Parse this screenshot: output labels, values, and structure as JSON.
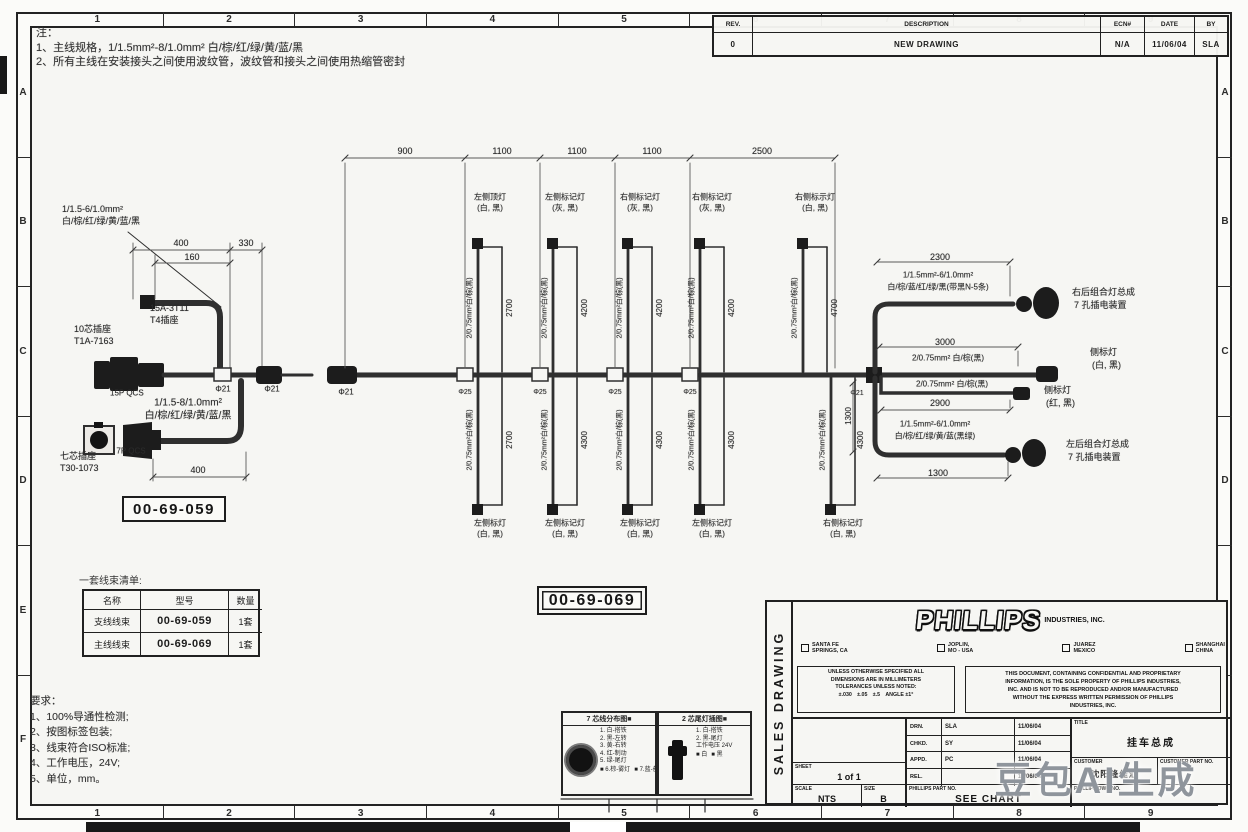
{
  "page": {
    "watermark": "豆包AI生成"
  },
  "zones": {
    "top": [
      "1",
      "2",
      "3",
      "4",
      "5",
      "6",
      "7",
      "8",
      "9"
    ],
    "bottom": [
      "1",
      "2",
      "3",
      "4",
      "5",
      "6",
      "7",
      "8",
      "9"
    ],
    "left": [
      "A",
      "B",
      "C",
      "D",
      "E",
      "F"
    ],
    "right": [
      "A",
      "B",
      "C",
      "D",
      "E",
      "F"
    ]
  },
  "notes_top": [
    "注：",
    "1、主线规格，1/1.5mm²-8/1.0mm² 白/棕/红/绿/黄/蓝/黑",
    "2、所有主线在安装接头之间使用波纹管，波纹管和接头之间使用热缩管密封"
  ],
  "revision_table": {
    "headers": [
      "REV.",
      "DESCRIPTION",
      "ECN#",
      "DATE",
      "BY"
    ],
    "rows": [
      [
        "0",
        "NEW DRAWING",
        "N/A",
        "11/06/04",
        "SLA"
      ]
    ]
  },
  "part_boxes": {
    "branch": "00-69-059",
    "main": "00-69-069"
  },
  "harness_list": {
    "caption": "一套线束清单:",
    "headers": [
      "名称",
      "型号",
      "数量"
    ],
    "rows": [
      [
        "支线线束",
        "00-69-059",
        "1套"
      ],
      [
        "主线线束",
        "00-69-069",
        "1套"
      ]
    ]
  },
  "requirements": {
    "title": "要求：",
    "items": [
      "1、100%导通性检测;",
      "2、按图标签包装;",
      "3、线束符合ISO标准;",
      "4、工作电压，24V;",
      "5、单位，mm。"
    ]
  },
  "legend_7pin": {
    "title": "7 芯线分布图■",
    "lines": [
      "1. 白-搭铁",
      "2. 黑-左转",
      "3. 黄-右转",
      "4. 红-制动",
      "5. 绿-尾灯"
    ],
    "swatches": [
      "■ 6.棕-雾灯",
      "■ 7.蓝-备用"
    ]
  },
  "legend_2pin": {
    "title": "2 芯尾灯插图■",
    "lines": [
      "1. 白-搭铁",
      "2. 黑-尾灯",
      "工作电压 24V"
    ],
    "swatches": [
      "■ 白",
      "■ 黑"
    ]
  },
  "title_block": {
    "side_label": "SALES DRAWING",
    "logo": "PHILLIPS",
    "logo_sub": "INDUSTRIES, INC.",
    "checkboxes": [
      [
        "SANTA FE",
        "SPRINGS, CA"
      ],
      [
        "JOPLIN,",
        "MO - USA"
      ],
      [
        "JUAREZ",
        "MEXICO"
      ],
      [
        "SHANGHAI",
        "CHINA"
      ]
    ],
    "tolerance_lines": [
      "UNLESS OTHERWISE SPECIFIED ALL",
      "DIMENSIONS ARE IN MILLIMETERS",
      "TOLERANCES UNLESS NOTED:",
      "±.030　±.05　±.5　ANGLE ±1°"
    ],
    "disclaimer_lines": [
      "THIS DOCUMENT, CONTAINING CONFIDENTIAL AND PROPRIETARY",
      "INFORMATION, IS THE SOLE PROPERTY OF PHILLIPS INDUSTRIES,",
      "INC. AND IS NOT TO BE REPRODUCED AND/OR MANUFACTURED",
      "WITHOUT THE EXPRESS WRITTEN PERMISSION OF PHILLIPS",
      "INDUSTRIES, INC."
    ],
    "sign_rows": [
      [
        "DRN.",
        "SLA",
        "11/06/04"
      ],
      [
        "CHKD.",
        "SY",
        "11/06/04"
      ],
      [
        "APPD.",
        "PC",
        "11/06/04"
      ],
      [
        "REL.",
        "",
        "11/06/04"
      ]
    ],
    "labels": {
      "sheet": "SHEET",
      "scale": "SCALE",
      "size": "SIZE",
      "part_no": "PHILLIPS PART NO.",
      "title": "TITLE",
      "customer": "CUSTOMER",
      "customer_part_no": "CUSTOMER PART NO.",
      "dwg_no": "PHILLIPS DWG NO."
    },
    "values": {
      "sheet": "1 of 1",
      "scale": "NTS",
      "size": "B",
      "part_no": "SEE CHART",
      "title": "挂车总成",
      "customer": "沈阳隆佳汇",
      "customer_part_no": "",
      "dwg_no": ""
    }
  },
  "diagram_texts": [
    {
      "t": "1/1.5-6/1.0mm²",
      "x": 62,
      "y": 210,
      "s": 9,
      "a": "l"
    },
    {
      "t": "白/棕/红/绿/黄/蓝/黑",
      "x": 62,
      "y": 222,
      "s": 9,
      "a": "l"
    },
    {
      "t": "400",
      "x": 181,
      "y": 244,
      "s": 9
    },
    {
      "t": "330",
      "x": 246,
      "y": 244,
      "s": 9
    },
    {
      "t": "160",
      "x": 192,
      "y": 258,
      "s": 9
    },
    {
      "t": "15A-3T11",
      "x": 150,
      "y": 309,
      "s": 9,
      "a": "l"
    },
    {
      "t": "T4插座",
      "x": 150,
      "y": 321,
      "s": 9,
      "a": "l"
    },
    {
      "t": "10芯插座",
      "x": 74,
      "y": 330,
      "s": 9,
      "a": "l"
    },
    {
      "t": "T1A-7163",
      "x": 74,
      "y": 342,
      "s": 9,
      "a": "l"
    },
    {
      "t": "15P QCS",
      "x": 110,
      "y": 394,
      "s": 8,
      "a": "l"
    },
    {
      "t": "Φ21",
      "x": 223,
      "y": 390,
      "s": 8
    },
    {
      "t": "Φ21",
      "x": 272,
      "y": 390,
      "s": 8
    },
    {
      "t": "1/1.5-8/1.0mm²",
      "x": 188,
      "y": 404,
      "s": 10
    },
    {
      "t": "白/棕/红/绿/黄/蓝/黑",
      "x": 188,
      "y": 417,
      "s": 10
    },
    {
      "t": "7P QCS",
      "x": 131,
      "y": 452,
      "s": 8
    },
    {
      "t": "七芯插座",
      "x": 60,
      "y": 457,
      "s": 9,
      "a": "l"
    },
    {
      "t": "T30-1073",
      "x": 60,
      "y": 469,
      "s": 9,
      "a": "l"
    },
    {
      "t": "400",
      "x": 198,
      "y": 471,
      "s": 9
    },
    {
      "t": "900",
      "x": 405,
      "y": 152,
      "s": 9
    },
    {
      "t": "1100",
      "x": 502,
      "y": 152,
      "s": 9
    },
    {
      "t": "1100",
      "x": 577,
      "y": 152,
      "s": 9
    },
    {
      "t": "1100",
      "x": 652,
      "y": 152,
      "s": 9
    },
    {
      "t": "2500",
      "x": 762,
      "y": 152,
      "s": 9
    },
    {
      "t": "Φ21",
      "x": 346,
      "y": 393,
      "s": 8
    },
    {
      "t": "Φ25",
      "x": 465,
      "y": 393,
      "s": 7
    },
    {
      "t": "Φ25",
      "x": 540,
      "y": 393,
      "s": 7
    },
    {
      "t": "Φ25",
      "x": 615,
      "y": 393,
      "s": 7
    },
    {
      "t": "Φ25",
      "x": 690,
      "y": 393,
      "s": 7
    },
    {
      "t": "Φ21",
      "x": 857,
      "y": 394,
      "s": 7
    },
    {
      "t": "左侧顶灯",
      "x": 490,
      "y": 198,
      "s": 8
    },
    {
      "t": "(白, 黑)",
      "x": 490,
      "y": 209,
      "s": 8
    },
    {
      "t": "左侧标记灯",
      "x": 565,
      "y": 198,
      "s": 8
    },
    {
      "t": "(灰, 黑)",
      "x": 565,
      "y": 209,
      "s": 8
    },
    {
      "t": "右侧标记灯",
      "x": 640,
      "y": 198,
      "s": 8
    },
    {
      "t": "(灰, 黑)",
      "x": 640,
      "y": 209,
      "s": 8
    },
    {
      "t": "右侧标记灯",
      "x": 712,
      "y": 198,
      "s": 8
    },
    {
      "t": "(灰, 黑)",
      "x": 712,
      "y": 209,
      "s": 8
    },
    {
      "t": "右侧标示灯",
      "x": 815,
      "y": 198,
      "s": 8
    },
    {
      "t": "(白, 黑)",
      "x": 815,
      "y": 209,
      "s": 8
    },
    {
      "t": "2/0.75mm²白/棕(黑)",
      "x": 470,
      "y": 308,
      "s": 7,
      "r": 1
    },
    {
      "t": "2700",
      "x": 510,
      "y": 308,
      "s": 8,
      "r": 1
    },
    {
      "t": "2/0.75mm²白/棕(黑)",
      "x": 545,
      "y": 308,
      "s": 7,
      "r": 1
    },
    {
      "t": "4200",
      "x": 585,
      "y": 308,
      "s": 8,
      "r": 1
    },
    {
      "t": "2/0.75mm²白/棕(黑)",
      "x": 620,
      "y": 308,
      "s": 7,
      "r": 1
    },
    {
      "t": "4200",
      "x": 660,
      "y": 308,
      "s": 8,
      "r": 1
    },
    {
      "t": "2/0.75mm²白/棕(黑)",
      "x": 692,
      "y": 308,
      "s": 7,
      "r": 1
    },
    {
      "t": "4200",
      "x": 732,
      "y": 308,
      "s": 8,
      "r": 1
    },
    {
      "t": "2/0.75mm²白/棕(黑)",
      "x": 795,
      "y": 308,
      "s": 7,
      "r": 1
    },
    {
      "t": "4700",
      "x": 835,
      "y": 308,
      "s": 8,
      "r": 1
    },
    {
      "t": "左侧标灯",
      "x": 490,
      "y": 524,
      "s": 8
    },
    {
      "t": "(白, 黑)",
      "x": 490,
      "y": 535,
      "s": 8
    },
    {
      "t": "左侧标记灯",
      "x": 565,
      "y": 524,
      "s": 8
    },
    {
      "t": "(白, 黑)",
      "x": 565,
      "y": 535,
      "s": 8
    },
    {
      "t": "左侧标记灯",
      "x": 640,
      "y": 524,
      "s": 8
    },
    {
      "t": "(白, 黑)",
      "x": 640,
      "y": 535,
      "s": 8
    },
    {
      "t": "左侧标记灯",
      "x": 712,
      "y": 524,
      "s": 8
    },
    {
      "t": "(白, 黑)",
      "x": 712,
      "y": 535,
      "s": 8
    },
    {
      "t": "右侧标记灯",
      "x": 843,
      "y": 524,
      "s": 8
    },
    {
      "t": "(白, 黑)",
      "x": 843,
      "y": 535,
      "s": 8
    },
    {
      "t": "2/0.75mm²白/棕(黑)",
      "x": 470,
      "y": 440,
      "s": 7,
      "r": 1
    },
    {
      "t": "2700",
      "x": 510,
      "y": 440,
      "s": 8,
      "r": 1
    },
    {
      "t": "2/0.75mm²白/棕(黑)",
      "x": 545,
      "y": 440,
      "s": 7,
      "r": 1
    },
    {
      "t": "4300",
      "x": 585,
      "y": 440,
      "s": 8,
      "r": 1
    },
    {
      "t": "2/0.75mm²白/棕(黑)",
      "x": 620,
      "y": 440,
      "s": 7,
      "r": 1
    },
    {
      "t": "4300",
      "x": 660,
      "y": 440,
      "s": 8,
      "r": 1
    },
    {
      "t": "2/0.75mm²白/棕(黑)",
      "x": 692,
      "y": 440,
      "s": 7,
      "r": 1
    },
    {
      "t": "4300",
      "x": 732,
      "y": 440,
      "s": 8,
      "r": 1
    },
    {
      "t": "2/0.75mm²白/棕(黑)",
      "x": 823,
      "y": 440,
      "s": 7,
      "r": 1
    },
    {
      "t": "4300",
      "x": 861,
      "y": 440,
      "s": 8,
      "r": 1
    },
    {
      "t": "2300",
      "x": 940,
      "y": 258,
      "s": 9
    },
    {
      "t": "1/1.5mm²-6/1.0mm²",
      "x": 938,
      "y": 276,
      "s": 8
    },
    {
      "t": "白/棕/蓝/红/绿/黑(带黑N-5条)",
      "x": 938,
      "y": 288,
      "s": 8
    },
    {
      "t": "右后组合灯总成",
      "x": 1072,
      "y": 293,
      "s": 9,
      "a": "l"
    },
    {
      "t": "7 孔插电装置",
      "x": 1074,
      "y": 306,
      "s": 9,
      "a": "l"
    },
    {
      "t": "3000",
      "x": 945,
      "y": 343,
      "s": 9
    },
    {
      "t": "2/0.75mm² 白/棕(黑)",
      "x": 948,
      "y": 359,
      "s": 8
    },
    {
      "t": "侧标灯",
      "x": 1090,
      "y": 353,
      "s": 9,
      "a": "l"
    },
    {
      "t": "(白, 黑)",
      "x": 1092,
      "y": 366,
      "s": 9,
      "a": "l"
    },
    {
      "t": "2/0.75mm² 白/棕(黑)",
      "x": 952,
      "y": 385,
      "s": 8
    },
    {
      "t": "2900",
      "x": 940,
      "y": 404,
      "s": 9
    },
    {
      "t": "侧标灯",
      "x": 1044,
      "y": 391,
      "s": 9,
      "a": "l"
    },
    {
      "t": "(红, 黑)",
      "x": 1046,
      "y": 404,
      "s": 9,
      "a": "l"
    },
    {
      "t": "1/1.5mm²-6/1.0mm²",
      "x": 935,
      "y": 425,
      "s": 8
    },
    {
      "t": "白/棕/红/绿/黄/蓝(黑绿)",
      "x": 935,
      "y": 437,
      "s": 8
    },
    {
      "t": "左后组合灯总成",
      "x": 1066,
      "y": 445,
      "s": 9,
      "a": "l"
    },
    {
      "t": "7 孔插电装置",
      "x": 1068,
      "y": 458,
      "s": 9,
      "a": "l"
    },
    {
      "t": "1300",
      "x": 938,
      "y": 474,
      "s": 9
    },
    {
      "t": "1300",
      "x": 849,
      "y": 416,
      "s": 8,
      "r": 1
    }
  ]
}
